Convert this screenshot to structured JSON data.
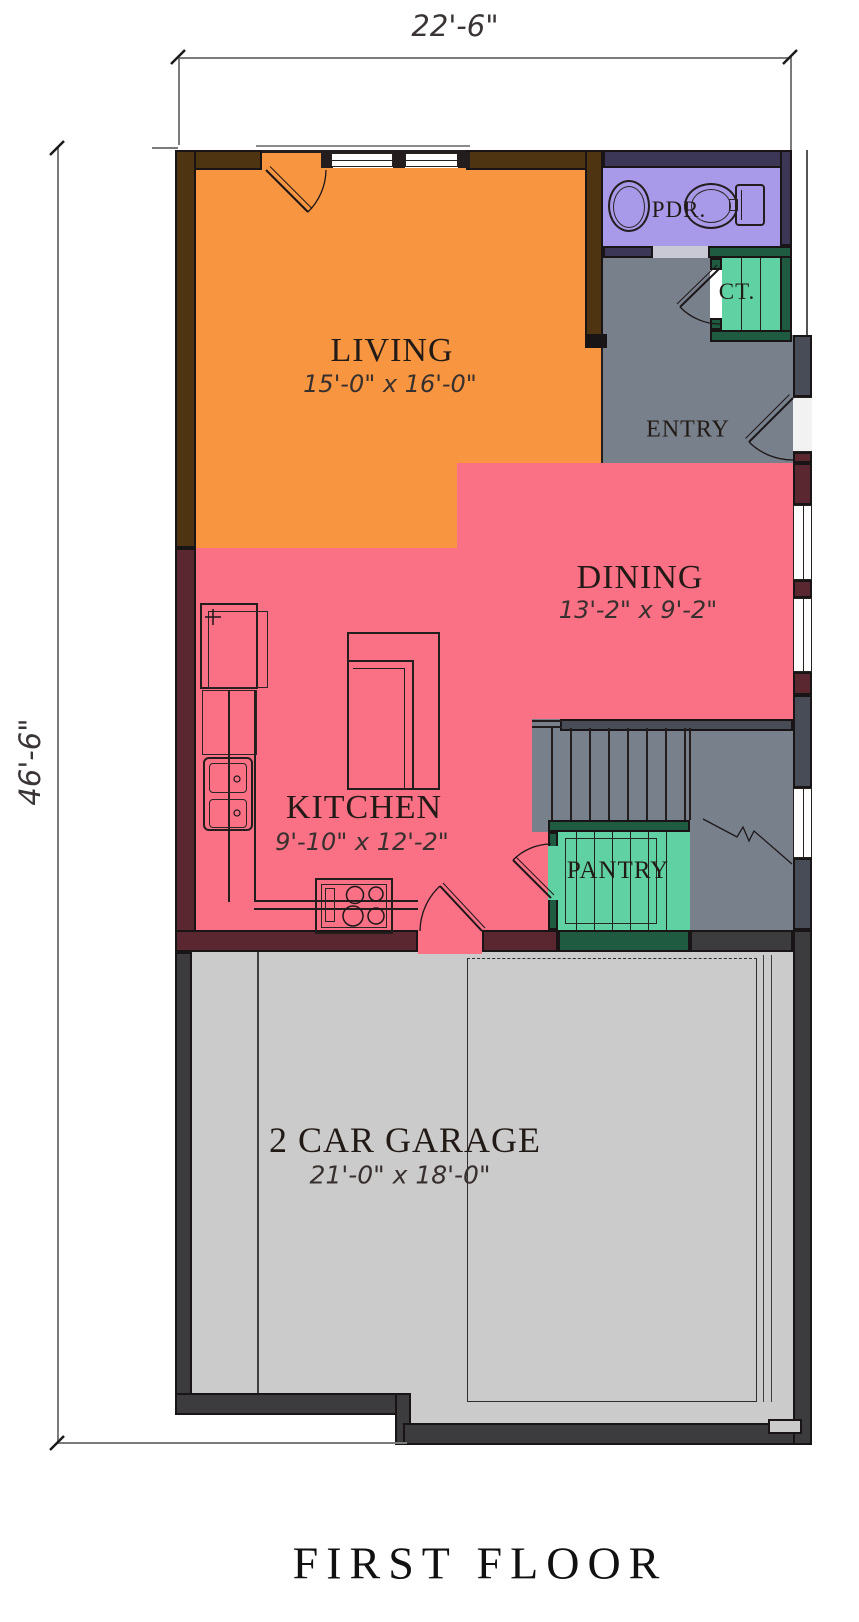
{
  "title": "FIRST FLOOR",
  "dimensions": {
    "top": "22'-6\"",
    "left": "46'-6\""
  },
  "rooms": {
    "living": {
      "name": "LIVING",
      "size": "15'-0\" x 16'-0\""
    },
    "dining": {
      "name": "DINING",
      "size": "13'-2\" x 9'-2\""
    },
    "kitchen": {
      "name": "KITCHEN",
      "size": "9'-10\" x 12'-2\""
    },
    "garage": {
      "name": "2 CAR GARAGE",
      "size": "21'-0\" x 18'-0\""
    },
    "entry": {
      "name": "ENTRY"
    },
    "pantry": {
      "name": "PANTRY"
    },
    "powder": {
      "name": "PDR."
    },
    "closet": {
      "name": "CT."
    }
  },
  "colors": {
    "living_fill": "#f79540",
    "dining_kitchen_fill": "#fa7084",
    "powder_fill": "#a89ae8",
    "closet_pantry_fill": "#5fd1a2",
    "entry_stairs_fill": "#78808c",
    "garage_fill": "#cbcbcb",
    "wall": "#191415"
  }
}
